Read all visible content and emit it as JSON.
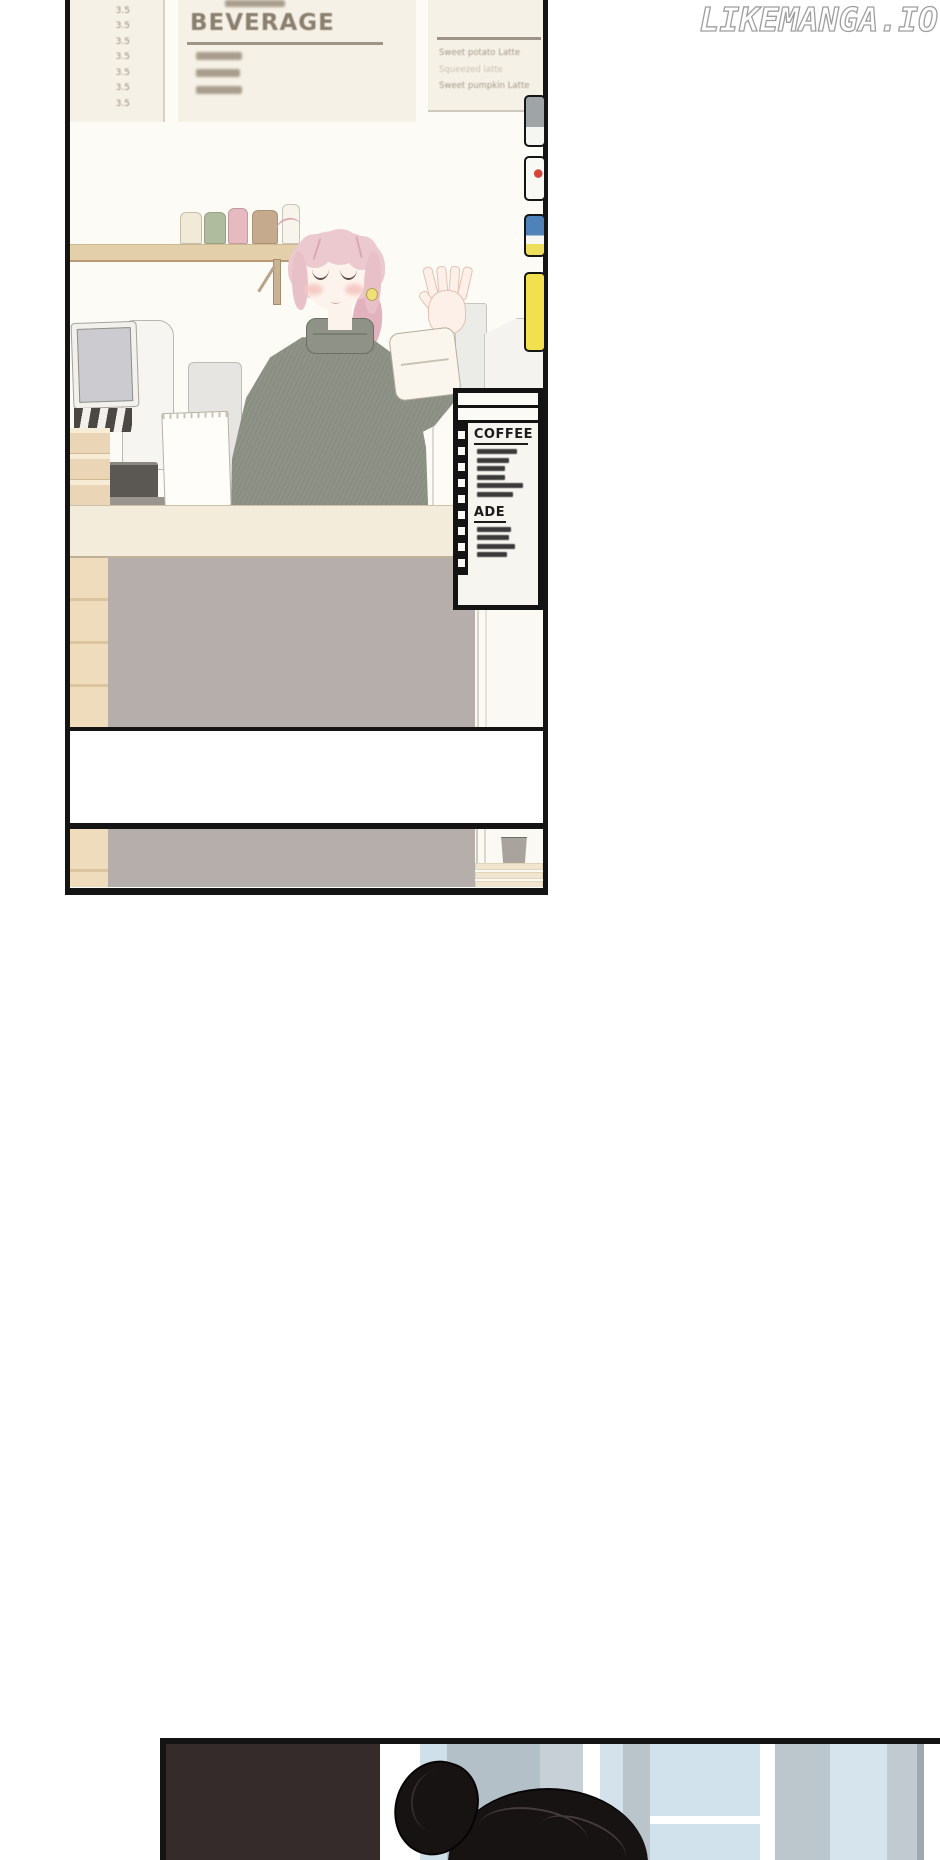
{
  "watermark": "LIKEMANGA.IO",
  "boards": {
    "left_prices": [
      "3.5",
      "3.5",
      "3.5",
      "3.5",
      "3.5",
      "3.5",
      "3.5"
    ],
    "beverage_title": "BEVERAGE",
    "beverage_items": [
      46,
      44,
      46
    ],
    "latte_items": [
      "Sweet potato Latte",
      "Squeezed latte",
      "Sweet pumpkin Latte"
    ]
  },
  "menu_stand": {
    "coffee_title": "COFFEE",
    "coffee_items": [
      40,
      32,
      28,
      28,
      46,
      36
    ],
    "ade_title": "ADE",
    "ade_items": [
      34,
      32,
      38,
      30
    ]
  },
  "shelf_cups": [
    {
      "x": 2,
      "w": 22,
      "h": 32,
      "c": "#f2ead8"
    },
    {
      "x": 26,
      "w": 22,
      "h": 32,
      "c": "#afbc9e"
    },
    {
      "x": 50,
      "w": 20,
      "h": 36,
      "c": "#e7b9c1"
    },
    {
      "x": 74,
      "w": 26,
      "h": 34,
      "c": "#c6aa8d"
    },
    {
      "x": 104,
      "w": 18,
      "h": 40,
      "c": "#f7f4ec"
    }
  ],
  "border_tags": [
    {
      "y": 95,
      "h": 52,
      "bg": "linear-gradient(180deg,#9fa5a7 0 62%,#f5f5f2 62%)"
    },
    {
      "y": 156,
      "h": 45,
      "bg": "radial-gradient(circle 4px at 68% 38%, #d44438 0 4px, #f8f8f5 4.5px)"
    },
    {
      "y": 214,
      "h": 43,
      "bg": "linear-gradient(180deg,#4f82b8 0 50%,#f6f6f2 50% 72%,#eede5c 72%)"
    },
    {
      "y": 272,
      "h": 80,
      "bg": "#f3e04e"
    }
  ],
  "window_panes": [
    {
      "x": 214,
      "w": 40,
      "c": "#ffffff"
    },
    {
      "x": 254,
      "w": 27,
      "c": "#cfe0eb"
    },
    {
      "x": 281,
      "w": 93,
      "c": "#b4c0c7"
    },
    {
      "x": 374,
      "w": 43,
      "c": "#c6d0d6"
    },
    {
      "x": 417,
      "w": 17,
      "c": "#ffffff"
    },
    {
      "x": 434,
      "w": 23,
      "c": "#d4e2ec"
    },
    {
      "x": 457,
      "w": 27,
      "c": "#b9c4cb"
    },
    {
      "x": 484,
      "w": 110,
      "c": "#d2e2ec"
    },
    {
      "x": 594,
      "w": 15,
      "c": "#ffffff"
    },
    {
      "x": 609,
      "w": 55,
      "c": "#bcc7cd"
    },
    {
      "x": 664,
      "w": 57,
      "c": "#d6e4ee"
    },
    {
      "x": 721,
      "w": 30,
      "c": "#c0cad0"
    },
    {
      "x": 751,
      "w": 7,
      "c": "#9fa8ad"
    },
    {
      "x": 758,
      "w": 16,
      "c": "#ffffff"
    }
  ],
  "colors": {
    "panel_border": "#141414",
    "board_background": "#f6f1e6",
    "board_text": "#8b8070",
    "counter_front": "#b6aeaa",
    "countertop": "#f4ecda",
    "wood": "#eedcbc",
    "sweater": "#8f9287",
    "hair_pink": "#ecc9cf",
    "skin": "#fdf3ed",
    "stand_frame": "#131313",
    "tag_yellow": "#f3e04e",
    "dark_block": "#352b2a",
    "hair_black": "#181313",
    "watermark_outline": "#9e9e9e"
  }
}
